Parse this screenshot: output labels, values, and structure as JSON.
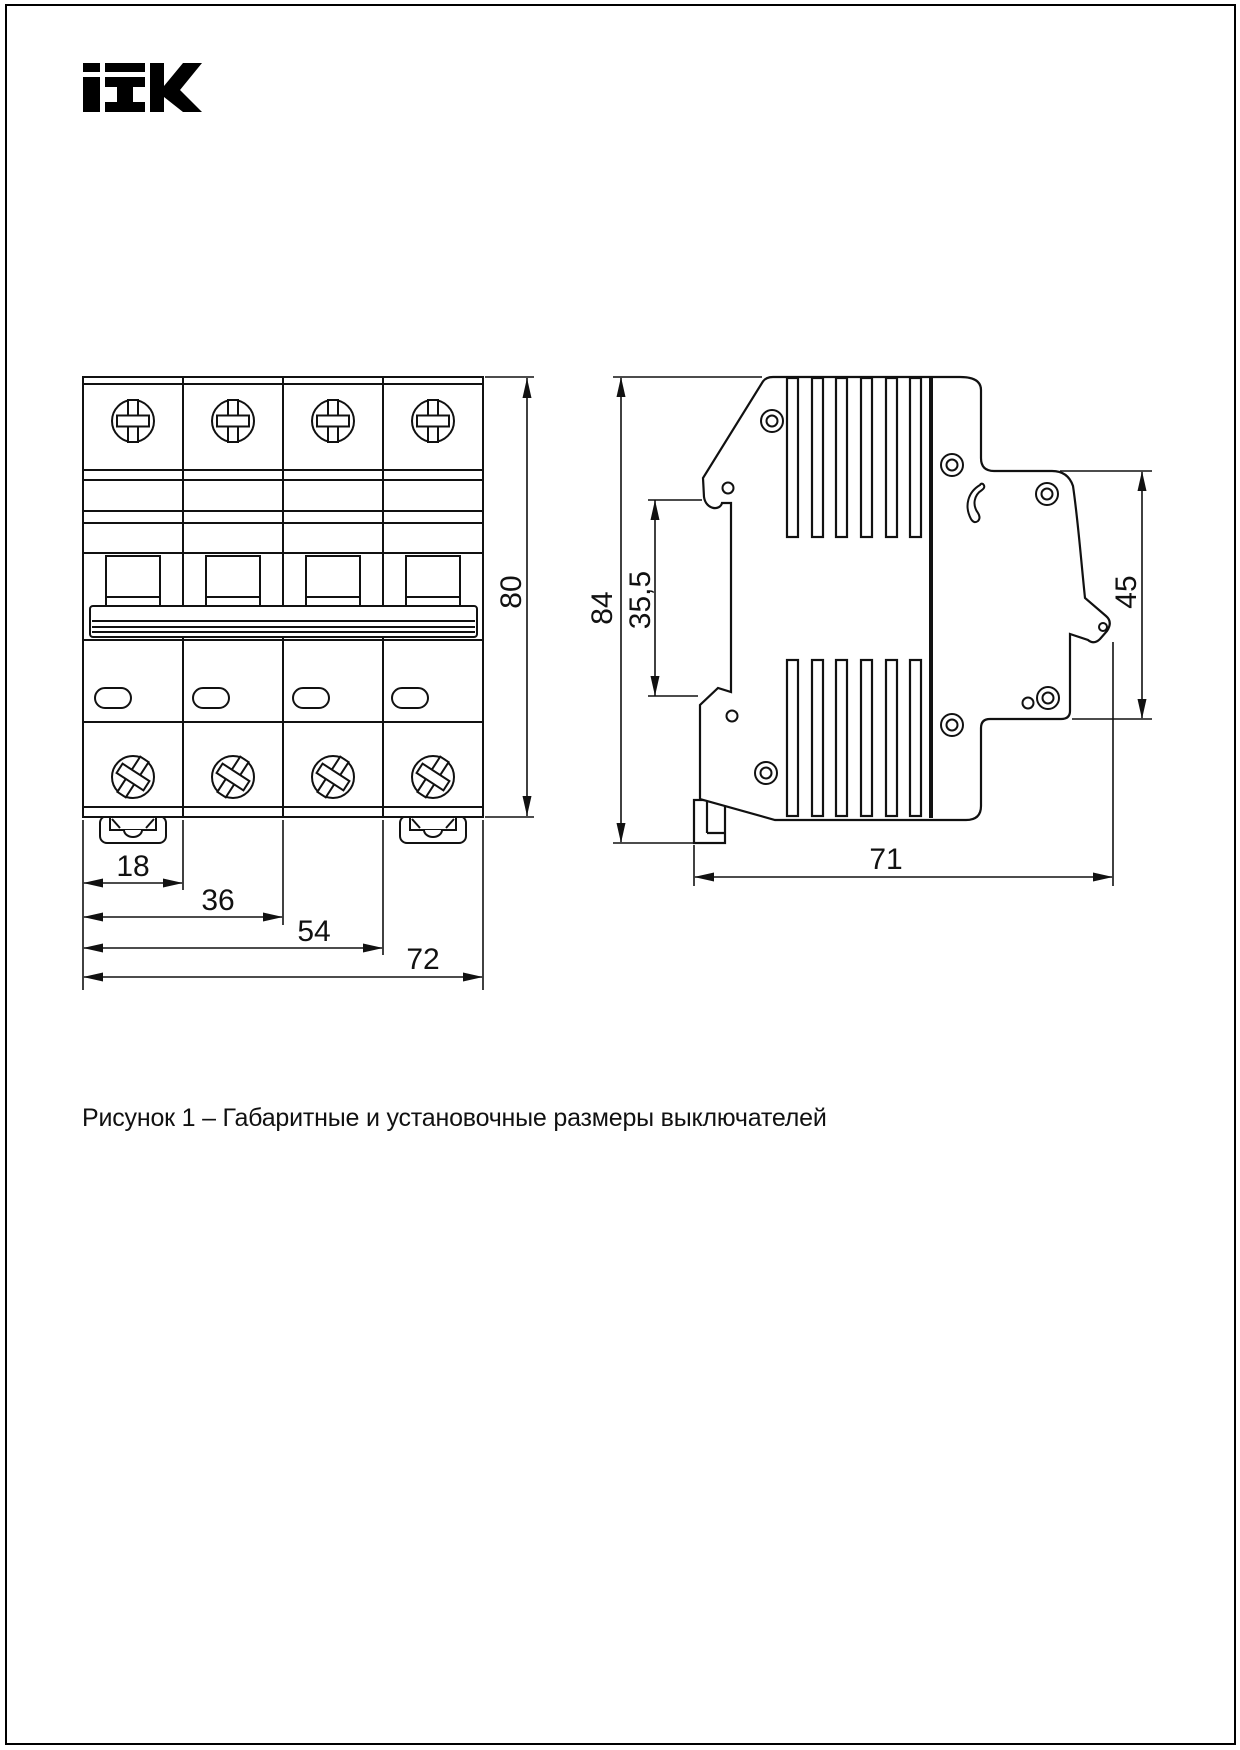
{
  "brand": {
    "name": "IEK"
  },
  "figure": {
    "caption": "Рисунок 1 – Габаритные и установочные размеры выключателей"
  },
  "front_view": {
    "description": "front view of 4-pole circuit breaker",
    "dims": {
      "module": "18",
      "two_modules": "36",
      "three_modules": "54",
      "total_width": "72",
      "height": "80"
    }
  },
  "side_view": {
    "description": "side view of circuit breaker",
    "dims": {
      "total_height": "84",
      "din_channel": "35,5",
      "front_step": "45",
      "depth": "71"
    }
  }
}
